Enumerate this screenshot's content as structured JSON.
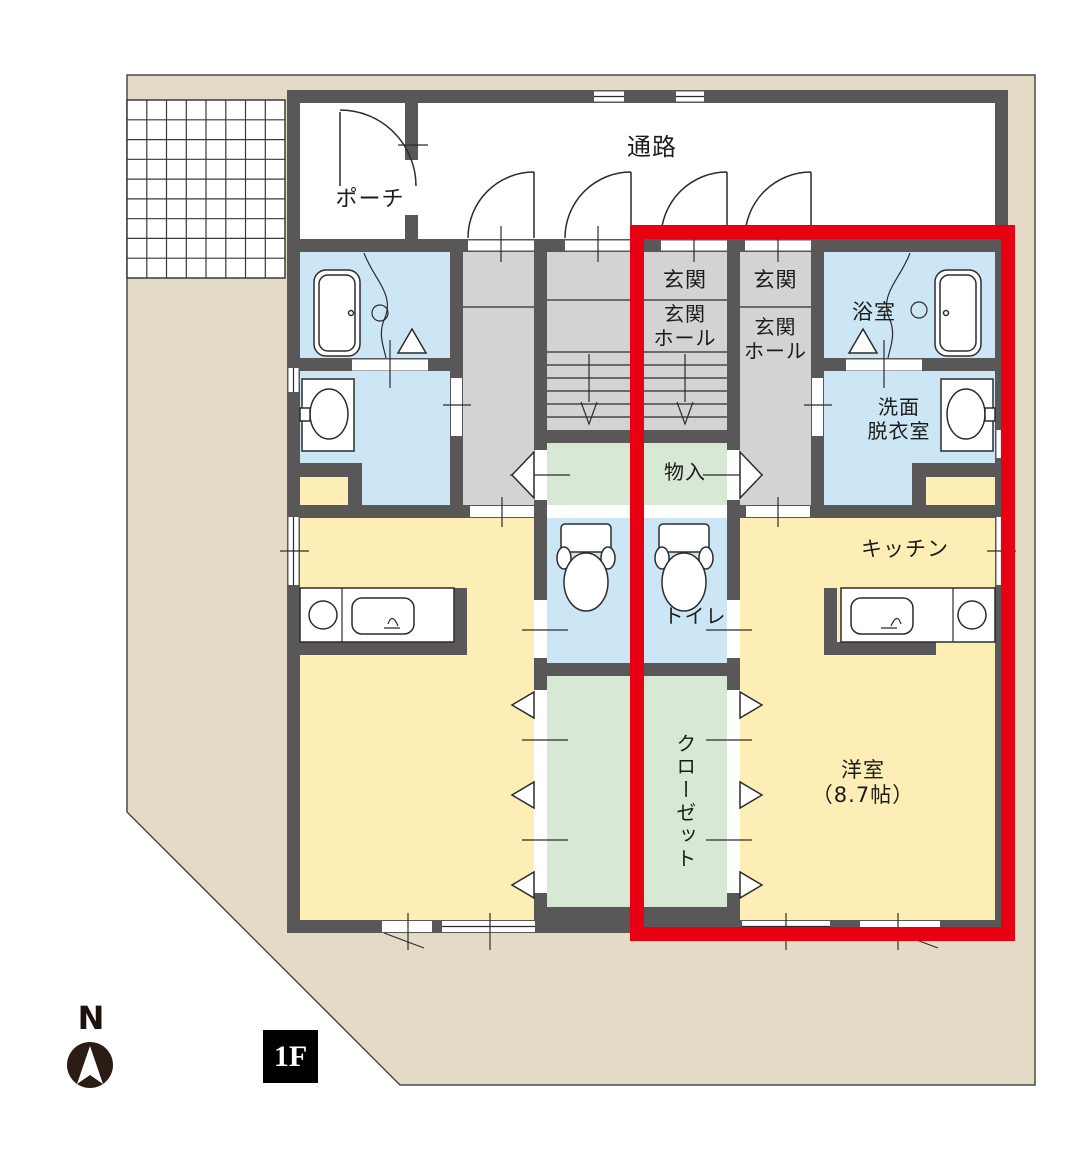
{
  "title": "1F間取り図",
  "floor_badge": "1F",
  "compass": {
    "label": "N"
  },
  "labels": {
    "passage": "通路",
    "porch": "ポーチ",
    "entrance_stairs": "玄関",
    "entrance_unit": "玄関",
    "entrance_hall_stairs": "玄関\nホール",
    "entrance_hall_unit": "玄関\nホール",
    "bathroom": "浴室",
    "washroom": "洗面\n脱衣室",
    "storage": "物入",
    "kitchen": "キッチン",
    "toilet": "トイレ",
    "closet": "クローゼット",
    "western_room": "洋室\n（8.7帖）"
  },
  "colors": {
    "site": "#e4dbc6",
    "wall": "#595757",
    "yellow": "#fdeeb6",
    "blue": "#cde6f5",
    "green": "#d7e8d4",
    "gray": "#d3d3d5",
    "red": "#e60012",
    "line": "#2c2c2c",
    "compass": "#2b1d15"
  }
}
